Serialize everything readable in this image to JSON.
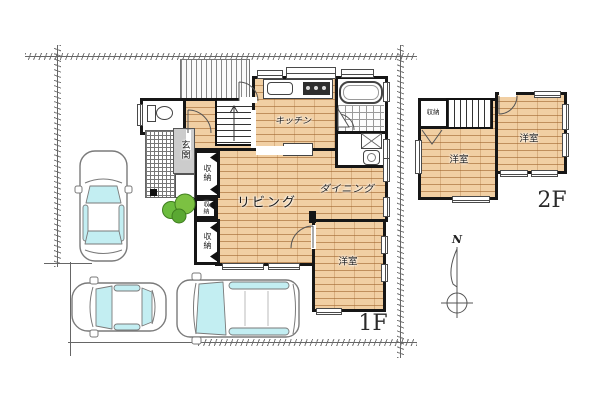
{
  "floor1": {
    "label": "1F",
    "rooms": {
      "living": "リビング",
      "dining": "ダイニング",
      "kitchen": "キッチン",
      "entrance": "玄関",
      "storage": "収納",
      "western_room": "洋室"
    }
  },
  "floor2": {
    "label": "2F",
    "rooms": {
      "western_room": "洋室",
      "storage": "収納"
    }
  },
  "compass": {
    "north": "N"
  },
  "colors": {
    "wood": "#f1cfa3",
    "wall": "#161616",
    "glass": "#c3eef2",
    "tree_green": "#7cc142",
    "entrance_bg": "#cccccc"
  }
}
